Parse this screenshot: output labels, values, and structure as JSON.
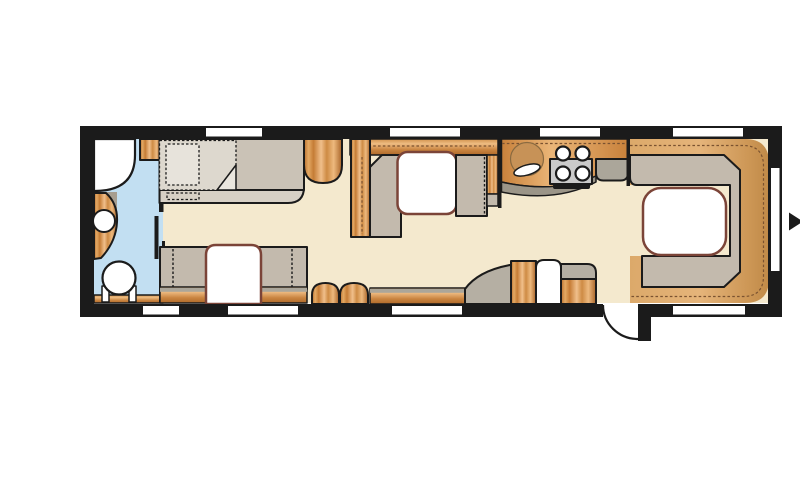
{
  "title": "Caravan floor plan",
  "colors": {
    "wall": "#1B1B1B",
    "floor": "#F4E9CE",
    "washroom_floor": "#C2DFF2",
    "upholstery": "#C3BAAD",
    "mattress": "#CAC2B6",
    "bed_base": "#D7D0C5",
    "bedding_light": "#DDD8CE",
    "bedding_fold": "#EAE6DE",
    "pillow": "#E7E3DB",
    "wood_dark": "#B96F2E",
    "wood_light": "#F0BF8B",
    "wood_floor": "#DCA96A",
    "table_top": "#FFFFFF",
    "table_border": "#7B4438",
    "counter_front": "#9B9588",
    "shelf_grey": "#ABA69A",
    "wheel_arch_grey": "#B5AFA3",
    "hob_metal": "#CACACA",
    "sink_basin": "#C79257",
    "appliance_white": "#FFFFFF",
    "window": "#FFFFFF"
  },
  "windows": {
    "top_wall": 4,
    "bottom_wall": 4,
    "right_wall": 1
  },
  "areas": {
    "washroom": {
      "fixtures": [
        "shower",
        "vanity-basin",
        "toilet",
        "door-leaf"
      ]
    },
    "front_bedroom": {
      "fixtures": [
        "double-bed",
        "pillow",
        "duvet",
        "wardrobe"
      ]
    },
    "side_dinette": {
      "fixtures": [
        "bench-seat",
        "table"
      ]
    },
    "mid_dinette": {
      "fixtures": [
        "facing-seats",
        "table",
        "wardrobe-columns"
      ]
    },
    "kitchen": {
      "fixtures": [
        "round-sink",
        "four-burner-hob",
        "worktop",
        "end-shelf"
      ]
    },
    "entrance": {
      "fixtures": [
        "entry-door",
        "fridge",
        "cabinets",
        "ottomans",
        "wheel-arch",
        "sideboard"
      ]
    },
    "rear_lounge": {
      "fixtures": [
        "u-shaped-seating",
        "table",
        "wood-floor"
      ]
    }
  },
  "direction_arrow": {
    "side": "right-wall-exterior",
    "points": "right"
  }
}
